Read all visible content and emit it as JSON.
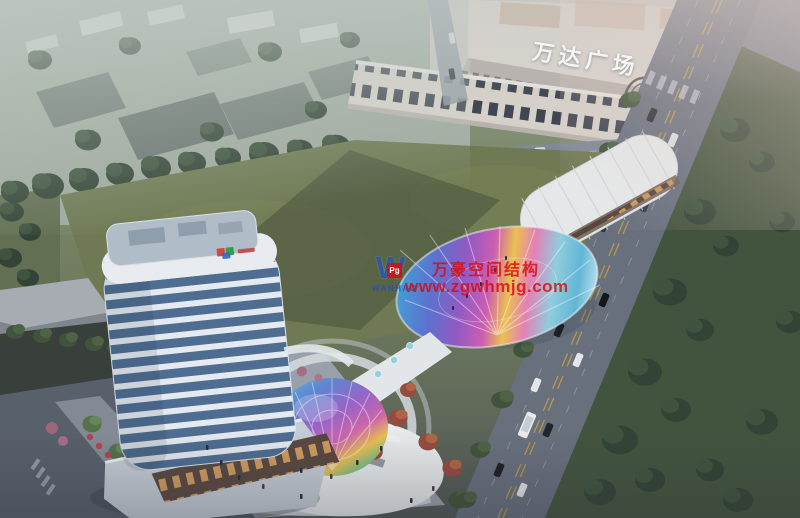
{
  "image": {
    "alt": "Aerial dusk rendering of a mixed-use plaza: high-rise tower, curved retail streets with rainbow glass canopies, central lawn, roads with traffic, and a mall"
  },
  "signs": {
    "mall_roof_sign": "万达广场"
  },
  "watermark": {
    "logo_letter": "W",
    "logo_seal": "Pg",
    "logo_caption": "WANHAO",
    "company": "万豪空间结构",
    "website": "www.zgwhmjg.com"
  },
  "palette": {
    "lawn": "#6d7950",
    "lawn_shadow": "#46513a",
    "road": "#666e7c",
    "mall": "#d6d0c9",
    "tower_glass": "#4a6b90",
    "tower_band": "#e9eef4",
    "retail_white": "#eceff0",
    "tree_dark": "#2f4231",
    "canopy_colors": [
      "#3f9fd8",
      "#9257c4",
      "#cf5ab2",
      "#f0c34c",
      "#8fd0e0"
    ],
    "watermark_red": "#d40f0f",
    "watermark_blue": "#2a52a8",
    "haze_pink": "#e8d0c8"
  }
}
